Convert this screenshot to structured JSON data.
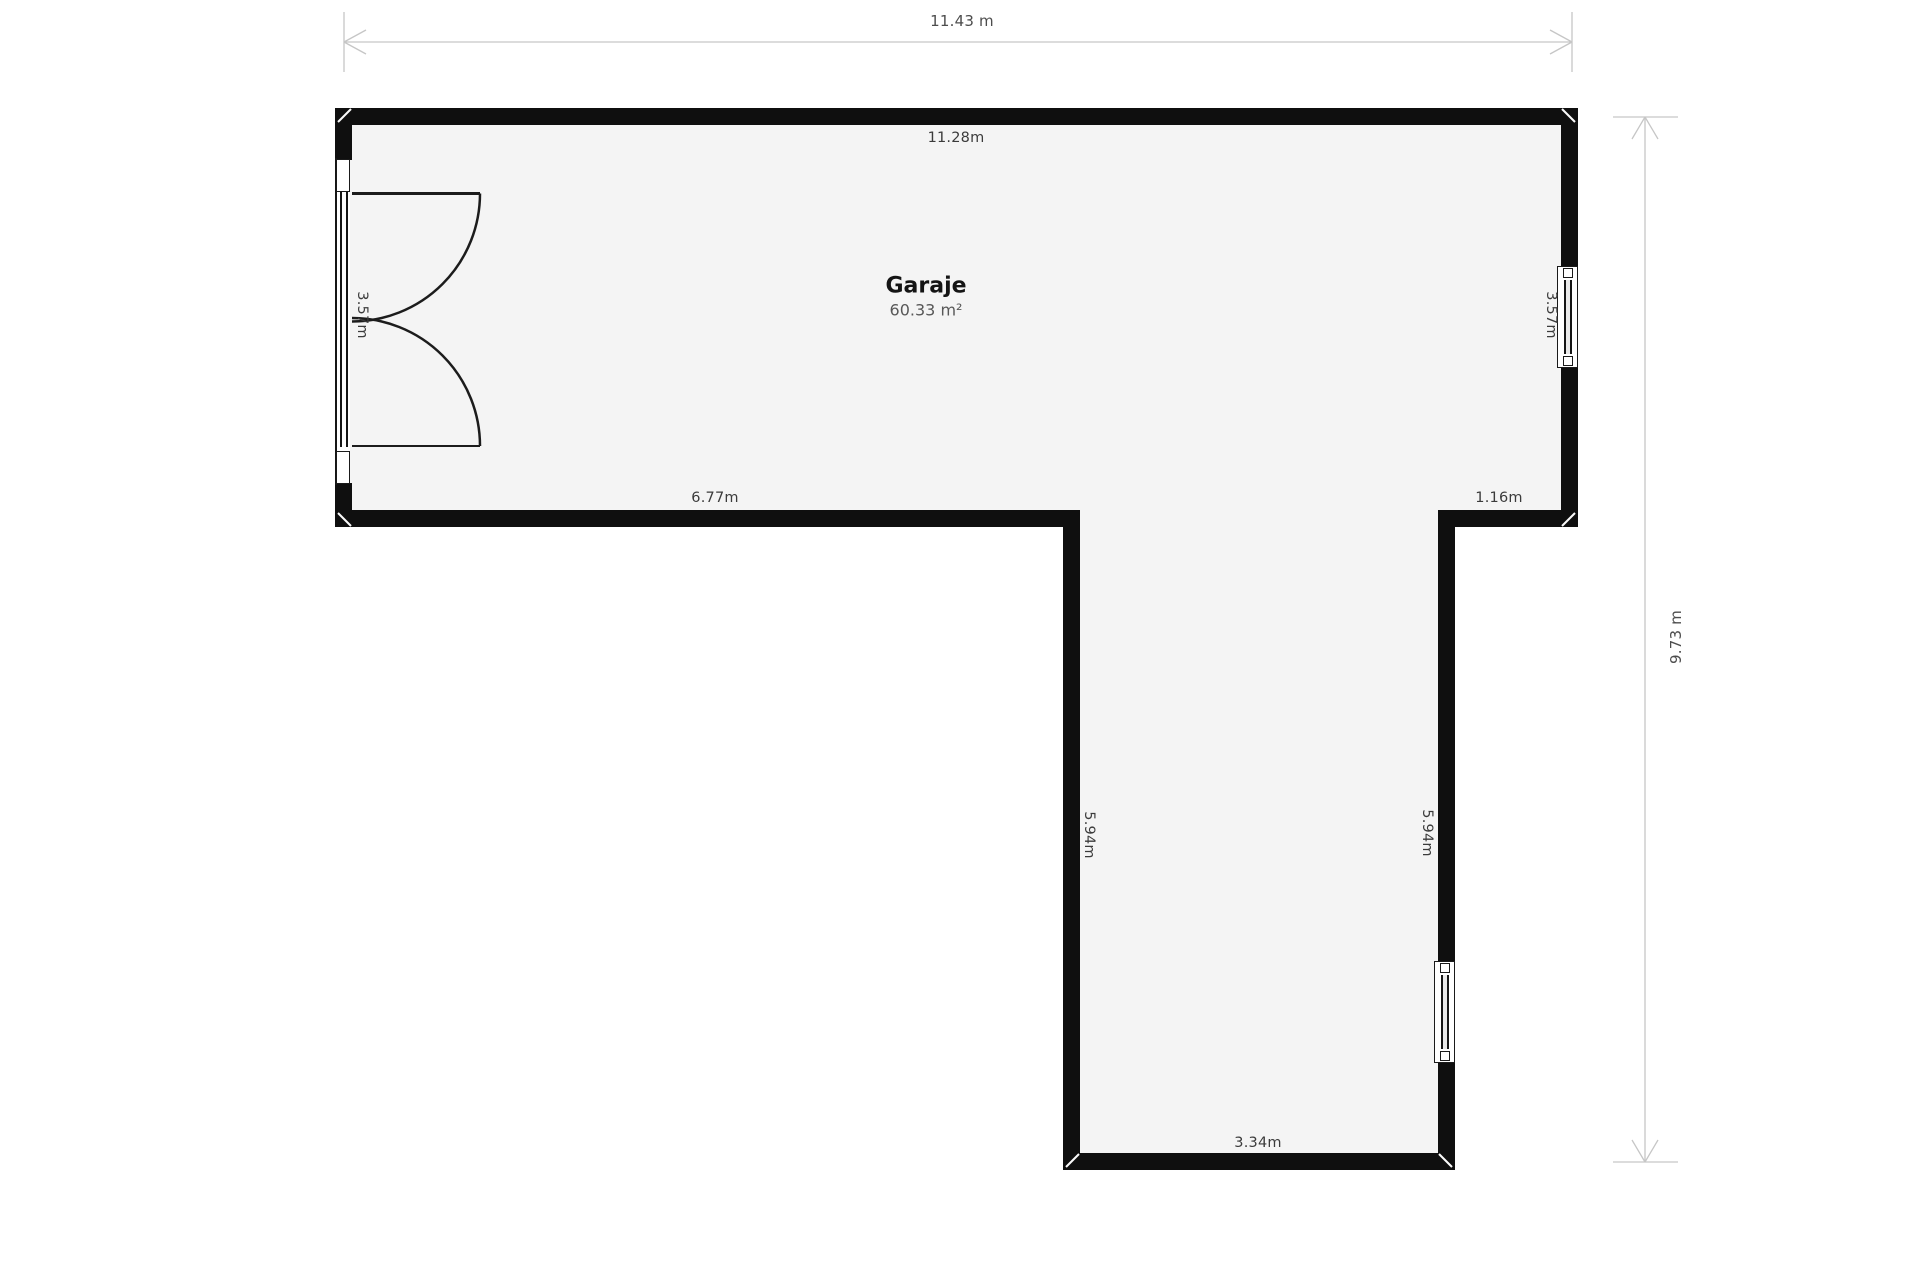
{
  "room": {
    "name": "Garaje",
    "area": "60.33 m²"
  },
  "overall_dimensions": {
    "width": "11.43 m",
    "height": "9.73 m"
  },
  "wall_labels": {
    "top": "11.28m",
    "left": "3.57m",
    "right": "3.57m",
    "bottom_left": "6.77m",
    "bottom_right": "1.16m",
    "stem_left": "5.94m",
    "stem_right": "5.94m",
    "stem_bottom": "3.34m"
  },
  "colors": {
    "wall": "#0f0f0f",
    "floor": "#f4f4f4",
    "background": "#ffffff",
    "dimension_line": "#c6c6c6",
    "label_text": "#3b3b3b",
    "area_text": "#585858"
  }
}
